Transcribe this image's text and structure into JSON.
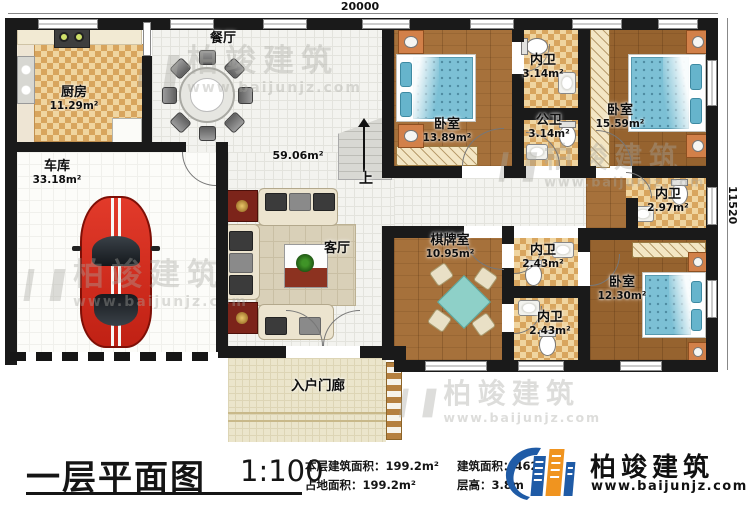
{
  "dimensions": {
    "top": "20000",
    "right": "11520"
  },
  "rooms": {
    "dining": {
      "name": "餐厅"
    },
    "kitchen": {
      "name": "厨房",
      "area": "11.29m²"
    },
    "garage": {
      "name": "车库",
      "area": "33.18m²"
    },
    "hall": {
      "area": "59.06m²"
    },
    "living": {
      "name": "客厅"
    },
    "stairs": {
      "label": "上"
    },
    "bedroom_top_left": {
      "name": "卧室",
      "area": "13.89m²"
    },
    "bath_ensuite_top": {
      "name": "内卫",
      "area": "3.14m²"
    },
    "bath_public": {
      "name": "公卫",
      "area": "3.14m²"
    },
    "bedroom_top_right": {
      "name": "卧室",
      "area": "15.59m²"
    },
    "bath_ensuite_right": {
      "name": "内卫",
      "area": "2.97m²"
    },
    "chess_room": {
      "name": "棋牌室",
      "area": "10.95m²"
    },
    "bath_ensuite_mid": {
      "name": "内卫",
      "area": "2.43m²"
    },
    "bath_ensuite_mid2": {
      "name": "内卫",
      "area": "2.43m²"
    },
    "bedroom_bottom_right": {
      "name": "卧室",
      "area": "12.30m²"
    },
    "porch": {
      "name": "入户门廊"
    }
  },
  "title_block": {
    "title": "一层平面图",
    "scale": "1:100",
    "stat1_label": "本层建筑面积：",
    "stat1_value": "199.2m²",
    "stat2_label": "占地面积：",
    "stat2_value": "199.2m²",
    "stat3_label": "建筑面积：",
    "stat3_value": "462",
    "stat4_label": "层高：",
    "stat4_value": "3.8m"
  },
  "brand": {
    "name": "柏竣建筑",
    "url": "www.baijunjz.com"
  },
  "colors": {
    "accent_blue": "#1f5ba6",
    "accent_orange": "#f0941f",
    "wall": "#1a1a1a",
    "bed_blue": "#7cc0d5"
  }
}
